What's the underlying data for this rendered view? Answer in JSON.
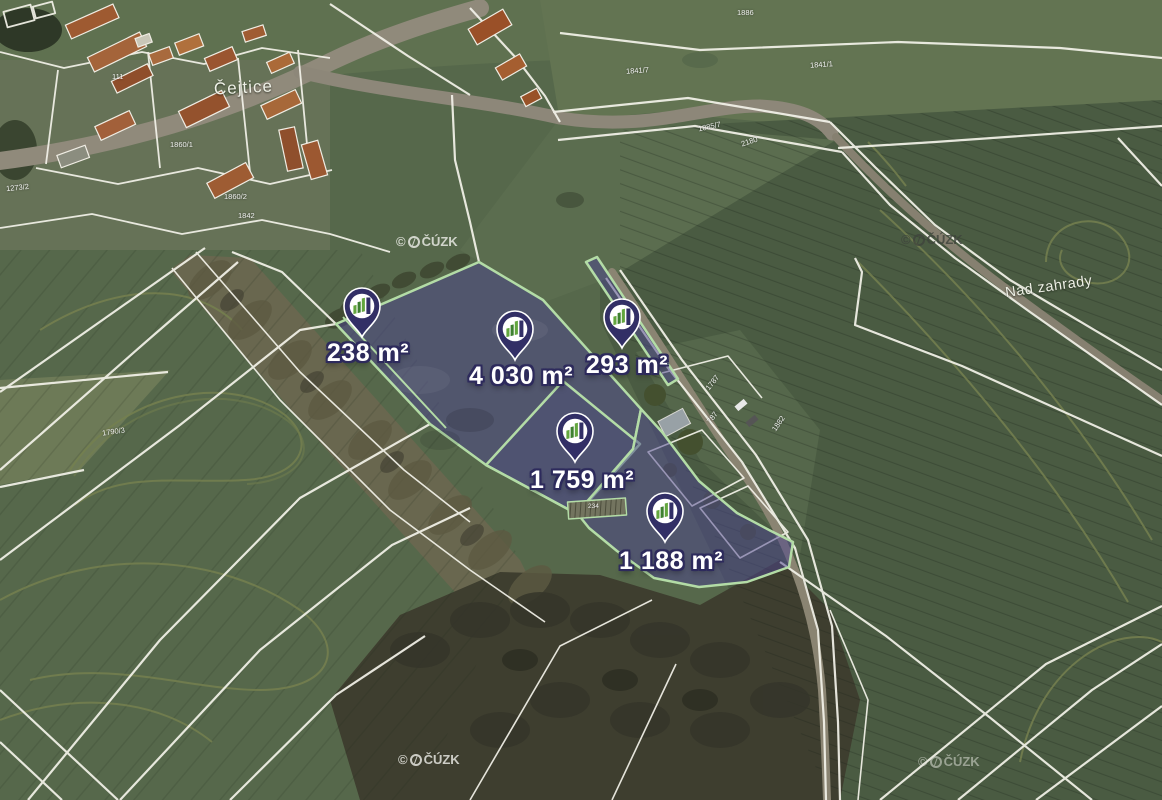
{
  "map": {
    "village_label": "Čejtice",
    "field_label": "Nad zahrady",
    "watermark": {
      "copyright": "©",
      "name": "ČÚZK"
    },
    "markers": [
      {
        "id": "238",
        "area": "238 m²"
      },
      {
        "id": "4030",
        "area": "4 030 m²"
      },
      {
        "id": "293",
        "area": "293 m²"
      },
      {
        "id": "1759",
        "area": "1 759 m²"
      },
      {
        "id": "1188",
        "area": "1 188 m²"
      }
    ],
    "parcel_numbers": [
      {
        "text": "1886"
      },
      {
        "text": "1841/7"
      },
      {
        "text": "1841/1"
      },
      {
        "text": "1885/7"
      },
      {
        "text": "2180"
      },
      {
        "text": "111"
      },
      {
        "text": "1273/2"
      },
      {
        "text": "1860/1"
      },
      {
        "text": "1860/2"
      },
      {
        "text": "1842"
      },
      {
        "text": "1790/3"
      },
      {
        "text": "1787"
      },
      {
        "text": "787"
      },
      {
        "text": "1882"
      },
      {
        "text": "234"
      }
    ],
    "colors": {
      "highlight_fill": "#4b4490",
      "parcel_border": "#b3dca6",
      "pin_navy": "#322f66",
      "label_outline": "#2d2a5c"
    }
  }
}
